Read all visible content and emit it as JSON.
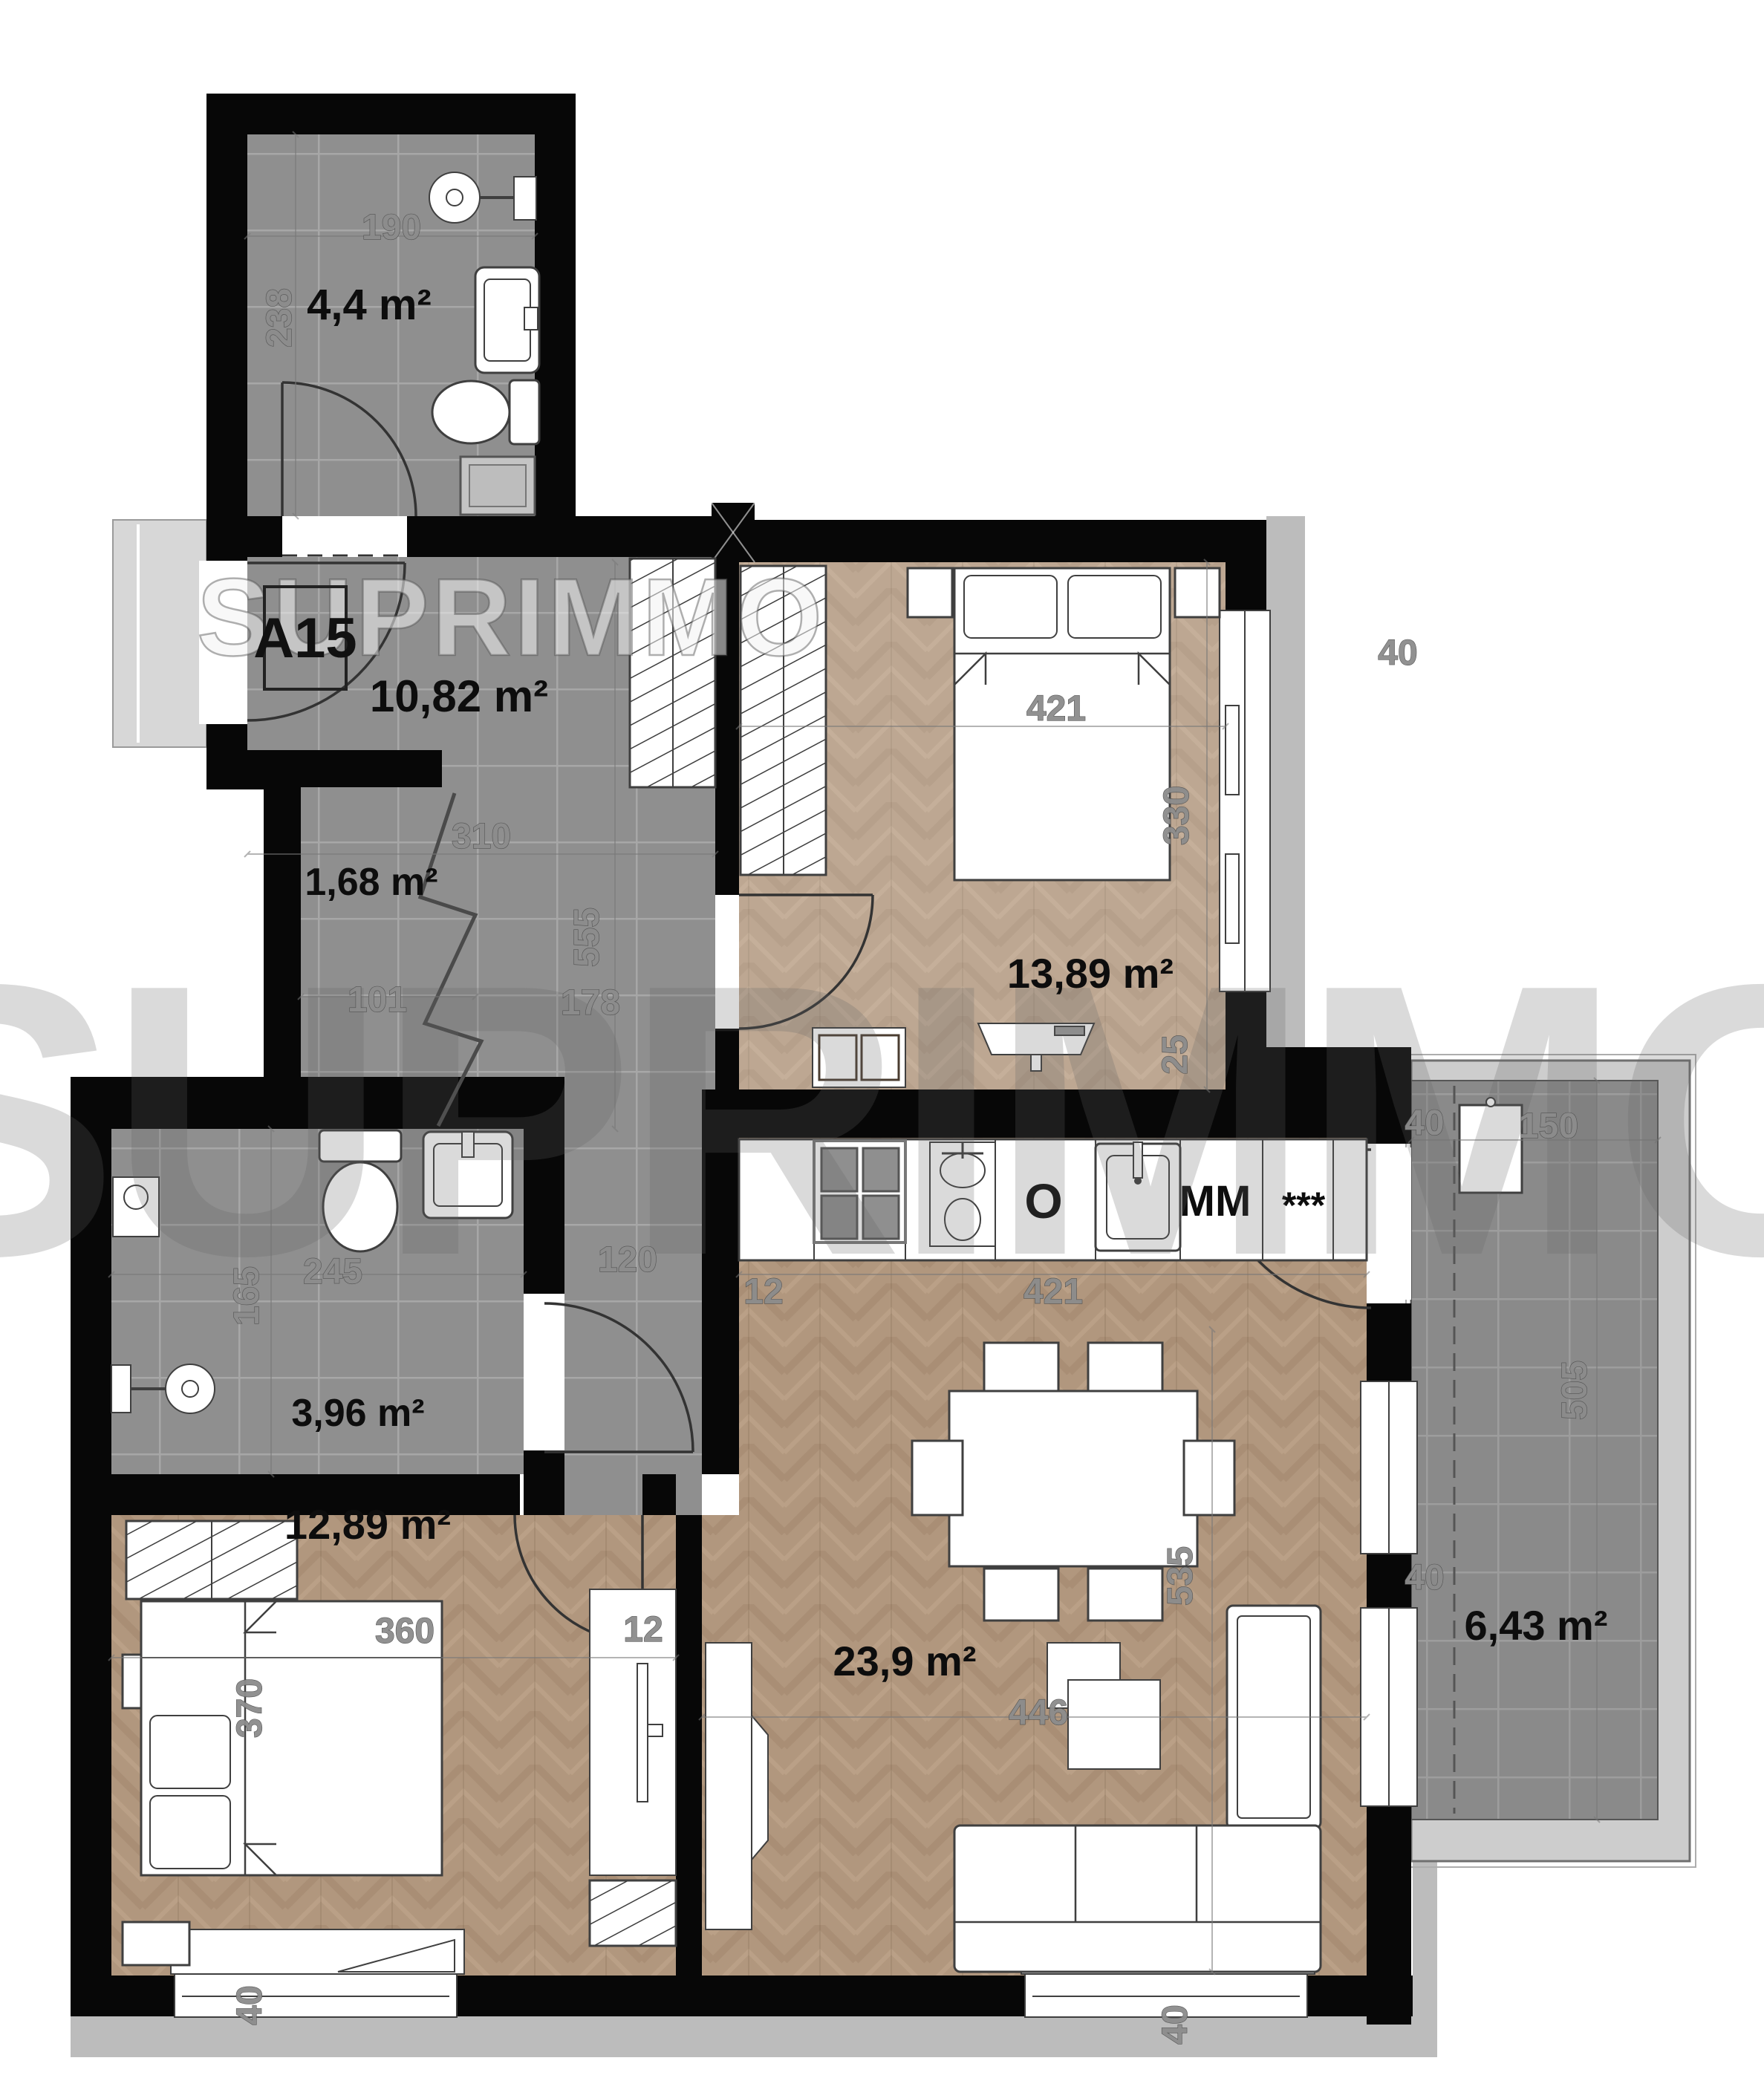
{
  "plan": {
    "unit_label": "A15",
    "watermark": "SUPRIMMO",
    "rooms": {
      "bath_top": {
        "area": "4,4 m²",
        "width": "190",
        "height": "238"
      },
      "hallway": {
        "area": "10,82 m²",
        "width": "310"
      },
      "closet": {
        "area": "1,68 m²",
        "width": "101"
      },
      "corridor": {
        "height": "555",
        "height2": "178",
        "width": "120"
      },
      "bath_lower": {
        "area": "3,96 m²",
        "height": "165",
        "width": "245"
      },
      "bedroom_top": {
        "area": "13,89 m²",
        "bed_width": "421",
        "height": "330",
        "offset": "25",
        "window": "40"
      },
      "kitchen": {
        "offset": "12",
        "width": "421",
        "oven": "O",
        "dishwasher": "MM",
        "fridge": "***"
      },
      "living": {
        "area": "23,9 m²",
        "height": "535",
        "width": "446",
        "pier_top": "40",
        "pier_bottom": "40",
        "window": "40"
      },
      "bedroom_bottom": {
        "area": "12,89 m²",
        "height": "370",
        "width": "360",
        "desk": "12",
        "window": "40"
      },
      "balcony": {
        "area": "6,43 m²",
        "width": "150",
        "height": "505"
      }
    }
  }
}
